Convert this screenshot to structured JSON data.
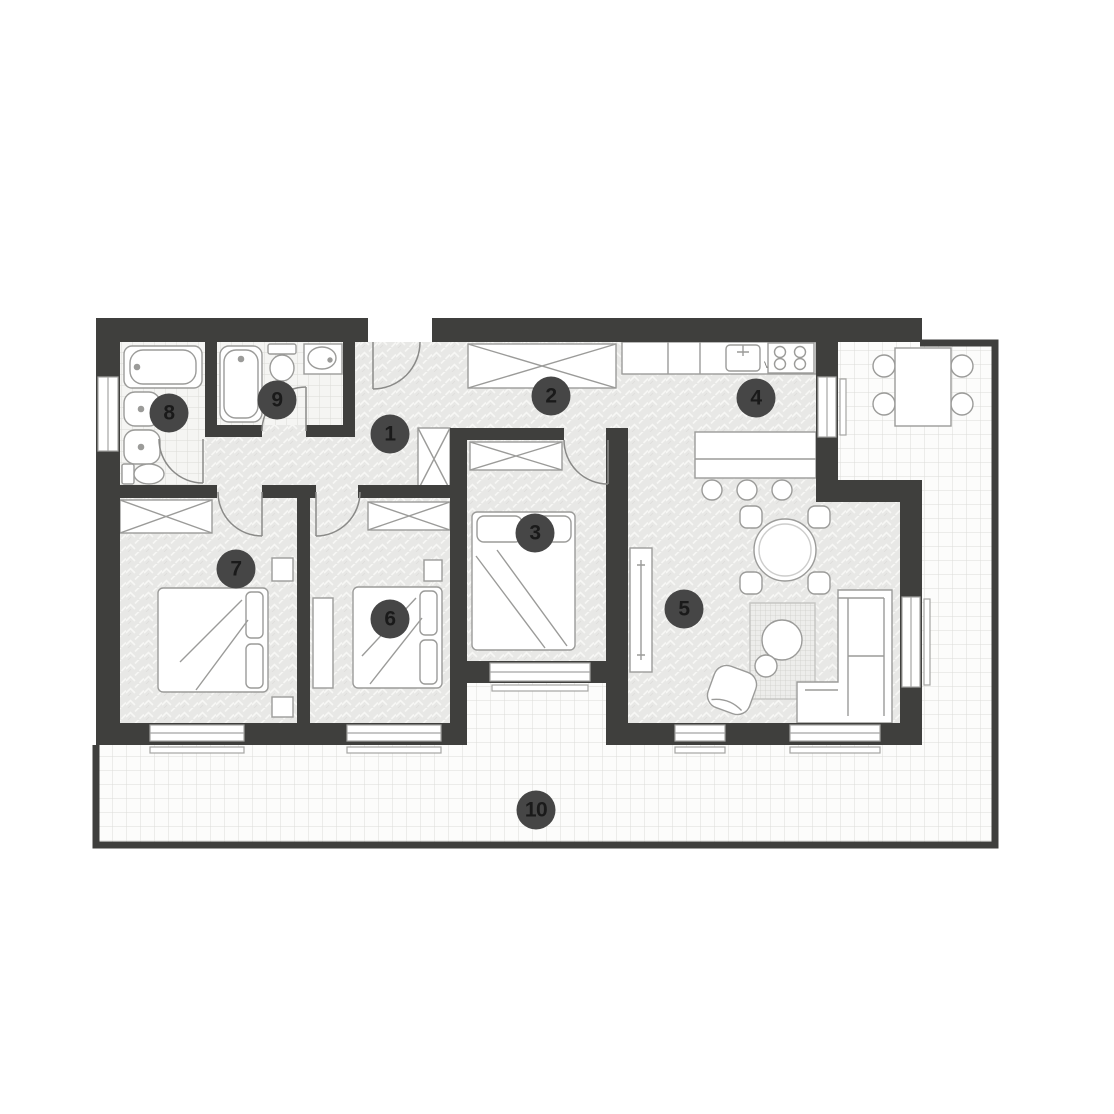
{
  "markers": [
    "1",
    "2",
    "3",
    "4",
    "5",
    "6",
    "7",
    "8",
    "9",
    "10"
  ],
  "kitchen": {
    "appliance_label": "VM"
  },
  "colors": {
    "wall": "#3f3f3d",
    "floor_interior": "#e8e8e6",
    "floor_chevron": "#f7f7f5",
    "bath_tile_bg": "#f5f5f3",
    "bath_tile_line": "#dbdbd7",
    "terrace_tile_bg": "#fcfcfb",
    "terrace_tile_line": "#dcdcd8",
    "furniture_fill": "#ffffff",
    "furniture_outline": "#9b9b99",
    "window_frame": "#a5a5a3",
    "door_arc": "#8a8a88",
    "marker_bg": "#464646",
    "marker_number": "#1a1a1a"
  }
}
